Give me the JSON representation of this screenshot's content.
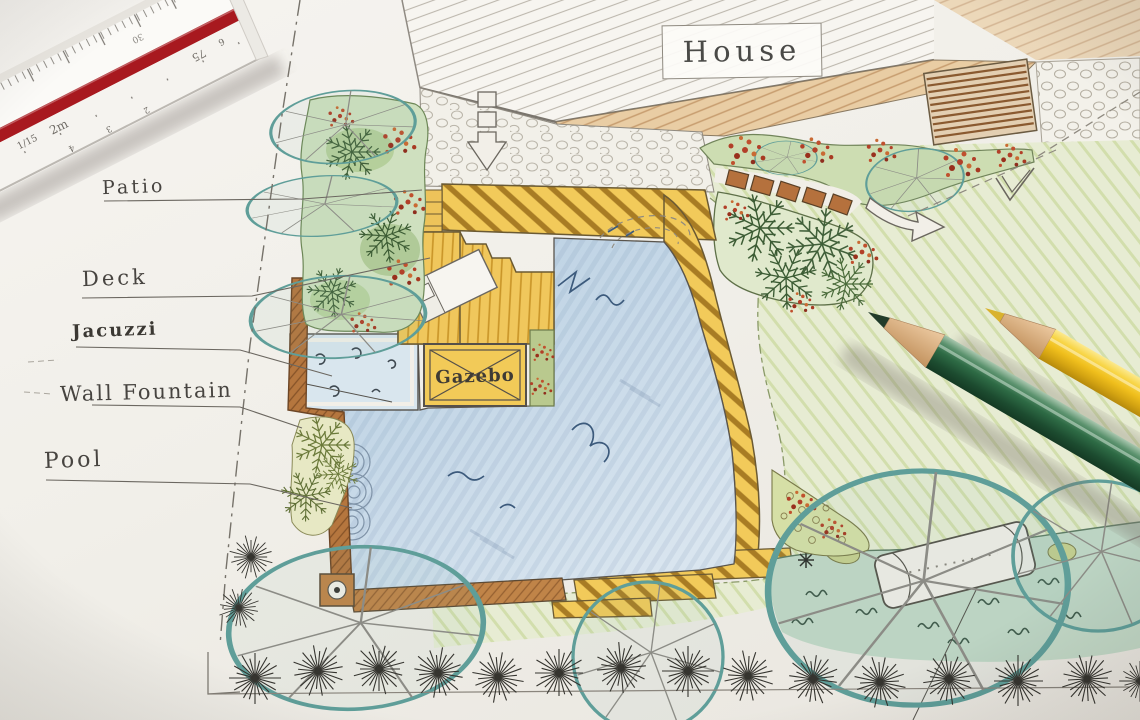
{
  "plan_labels": {
    "house": "House",
    "patio": "Patio",
    "deck": "Deck",
    "jacuzzi": "Jacuzzi",
    "wall_fountain": "Wall Fountain",
    "pool": "Pool",
    "gazebo": "Gazebo"
  },
  "ruler": {
    "scale_fraction": "1/15",
    "meter_mark": "2m",
    "upper_number": "30",
    "right_mark": "75",
    "right_small_mark": "6",
    "lower_ticks": [
      "2",
      "3",
      "4"
    ]
  },
  "colors": {
    "paper": "#f1efe9",
    "pool_water": "#c7d9e8",
    "deck_yellow": "#f2ca5a",
    "stripe_brown": "#a87c24",
    "wood_tan": "#e9cda4",
    "lawn_green": "#e7ecd3",
    "tree_teal": "#5f9e99",
    "bed_green": "#cfe0bf",
    "wall_brown": "#b5763e",
    "ruler_red": "#a8191f",
    "pencil_green": "#2e6b45",
    "pencil_yellow": "#f0bf1d",
    "shrub_dark": "#35342f",
    "label_ink": "#474440"
  }
}
